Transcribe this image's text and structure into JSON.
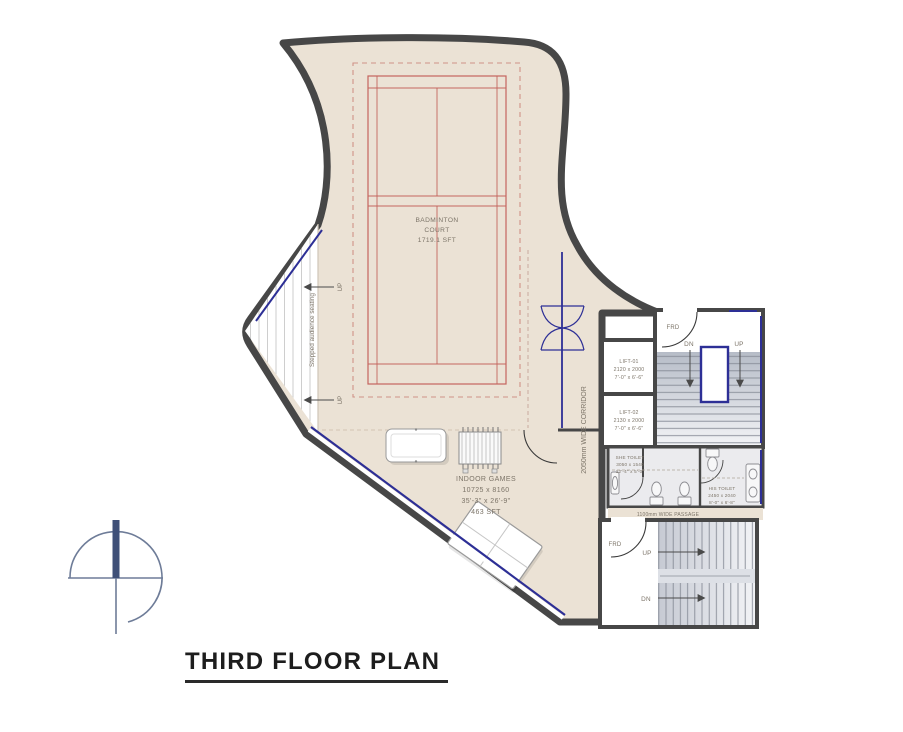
{
  "title": "THIRD FLOOR PLAN",
  "palette": {
    "wall_dark": "#474747",
    "floor_beige": "#ebe2d5",
    "court_red": "#c4655e",
    "glazing_blue": "#2d2f96",
    "stair_gray": "#c6cad3",
    "label_gray": "#7c7468"
  },
  "rooms": {
    "badminton_court": {
      "line1": "BADMINTON",
      "line2": "COURT",
      "line3": "1719.1 SFT"
    },
    "indoor_games": {
      "line1": "INDOOR GAMES",
      "line2": "10725 x 8160",
      "line3": "35'-3\" x 26'-9\"",
      "line4": "463 SFT"
    },
    "lift_01": {
      "line1": "LIFT-01",
      "line2": "2120 x 2000",
      "line3": "7'-0\" x 6'-6\""
    },
    "lift_02": {
      "line1": "LIFT-02",
      "line2": "2130 x 2000",
      "line3": "7'-0\" x 6'-6\""
    },
    "she_toilet": {
      "line1": "SHE TOILET",
      "line2": "3050 x 1540",
      "line3": "12'-4\" x 5'-0\""
    },
    "his_toilet": {
      "line1": "HIS TOILET",
      "line2": "2450 x 2040",
      "line3": "8'-0\" x 6'-8\""
    },
    "corridor": {
      "label": "2050mm WIDE CORRIDOR"
    },
    "passage": {
      "label": "1100mm WIDE PASSAGE"
    },
    "seating": {
      "label": "Stepped audience seating"
    }
  },
  "markers": {
    "up": "UP",
    "dn": "DN",
    "frd": "FRD"
  }
}
